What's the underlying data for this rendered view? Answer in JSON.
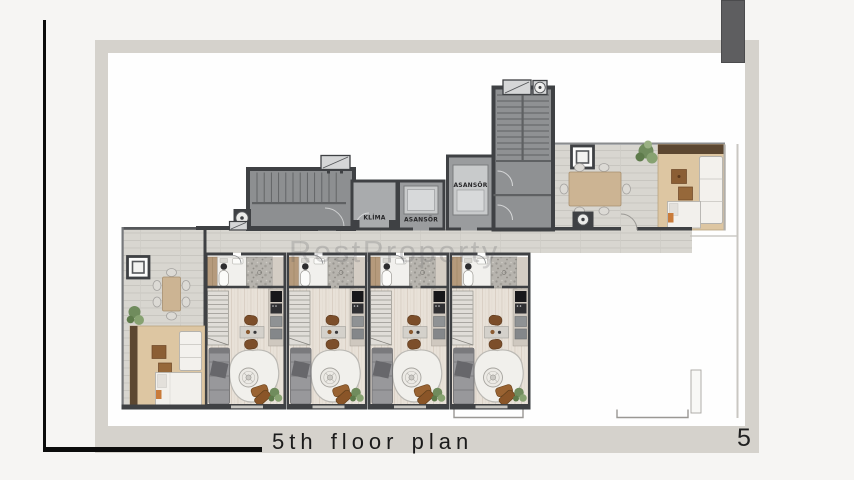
{
  "slide": {
    "caption": "5th floor plan",
    "page_number": "5",
    "watermark": "RestProperty"
  },
  "plan": {
    "labels": {
      "elevator_upper": "ASANSÖR",
      "elevator_lower": "ASANSÖR",
      "hvac_room": "KLİMA"
    }
  },
  "colors": {
    "background": "#f6f5f3",
    "frame": "#d5d2cc",
    "accent_bar": "#5e5e60",
    "ink": "#1b1b1b",
    "wall": "#3f4144",
    "deck": "#d8d6d0",
    "unit_floor": "#e8e1d8",
    "terrace_wood": "#ddc6a2",
    "furniture_brown": "#8b5e34"
  }
}
